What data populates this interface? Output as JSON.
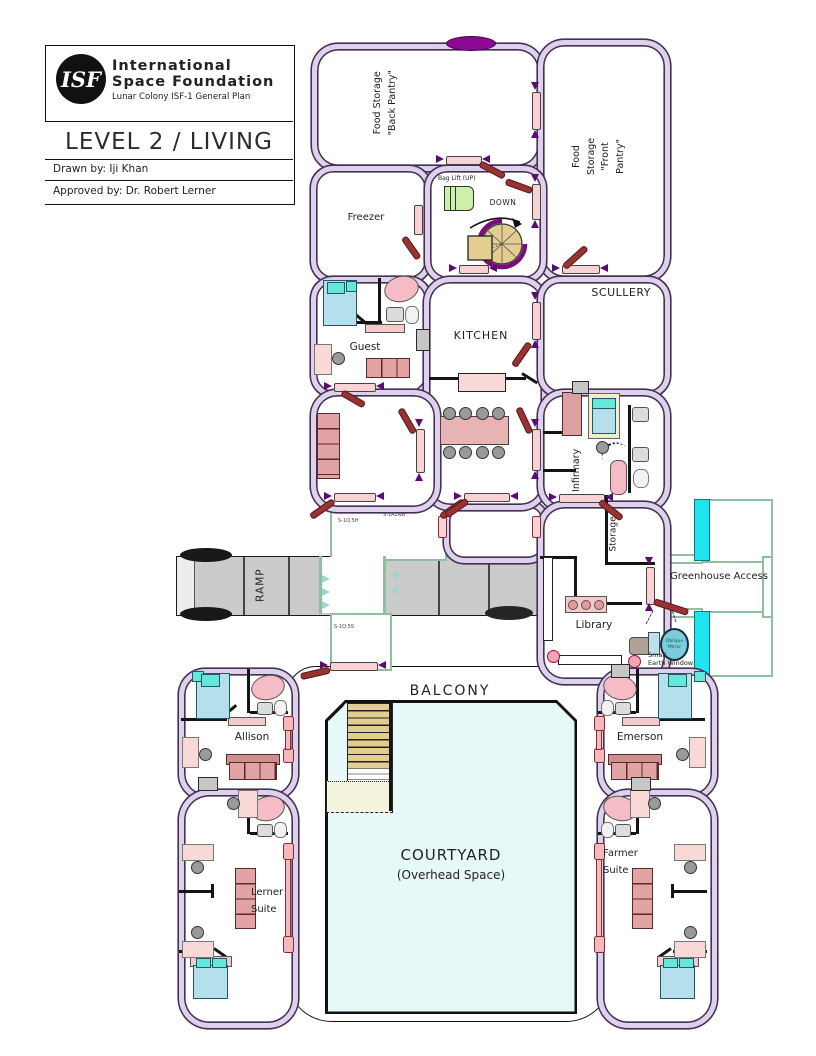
{
  "title_block": {
    "logo": "ISF",
    "org_name_line1": "International",
    "org_name_line2": "Space Foundation",
    "plan_subtitle": "Lunar Colony ISF-1 General Plan",
    "level_title": "LEVEL 2  / LIVING",
    "drawn_by": "Drawn by: Iji Khan",
    "approved_by": "Approved by: Dr. Robert Lerner"
  },
  "rooms": {
    "back_pantry": "Food Storage\n\"Back Pantry\"",
    "front_pantry": "Food Storage\n\"Front Pantry\"",
    "freezer": "Freezer",
    "guest": "Guest",
    "kitchen": "KITCHEN",
    "scullery": "SCULLERY",
    "infirmary": "Infirmary",
    "storage": "Storage",
    "library": "Library",
    "greenhouse_access": "Greenhouse Access",
    "ramp": "RAMP",
    "balcony": "BALCONY",
    "courtyard": "COURTYARD",
    "courtyard_sub": "(Overhead Space)",
    "allison": "Allison",
    "emerson": "Emerson",
    "lerner_suite": "Lerner\nSuite",
    "farmer_suite": "Farmer\nSuite"
  },
  "annotations": {
    "bag_lift": "Bag Lift (UP)",
    "down": "DOWN",
    "oblique_mirror": "Oblique\nMirror",
    "small_earth_window": "Small\nEarth Window",
    "section_tag_a": "S-1Q.5H",
    "section_tag_b": "S-1A2&B",
    "section_tag_c": "S-1Q.5S"
  },
  "colors": {
    "wall_fill": "#ddd1ec",
    "wall_line": "#453053",
    "door_pink": "#f8d2d4",
    "door_leaf_red": "#993233",
    "arrow_purple": "#5c0b72",
    "hatch_purple": "#8a0a92",
    "courtyard_fill": "#e7f8f9",
    "greenhouse_glass": "#1fe3ef",
    "stair_tread": "#e4cd90",
    "ramp_gray": "#cbcbcb",
    "bed_blue": "#b5dfeb",
    "pillow_teal": "#66e8d8",
    "sofa_rose": "#e1a3a3",
    "desk_pink": "#f9d8d8",
    "bag_lift_green": "#cdf0a8"
  }
}
